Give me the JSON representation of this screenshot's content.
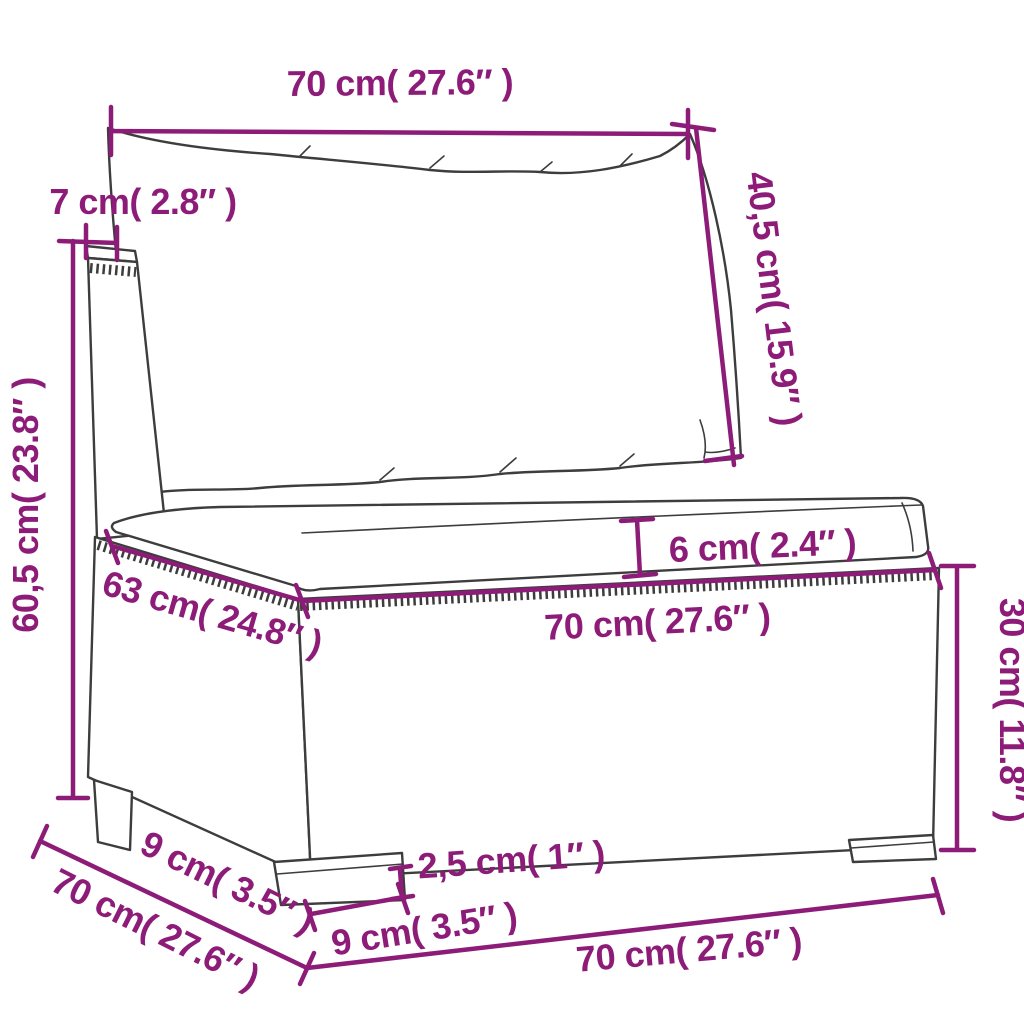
{
  "title": "Sofa section dimension diagram",
  "product": "poly rattan garden sofa middle section with back and seat cushions",
  "colors": {
    "dimension": "#8D1C78",
    "line_art": "#3D3D3D",
    "background": "#FFFFFF"
  },
  "dimensions": {
    "back_cushion_width": "70 cm( 27.6″ )",
    "back_cushion_height": "40,5 cm( 15.9″ )",
    "back_frame_thickness": "7 cm( 2.8″ )",
    "total_height": "60,5 cm( 23.8″ )",
    "seat_cushion_thickness": "6 cm( 2.4″ )",
    "seat_width": "70 cm( 27.6″ )",
    "seat_depth": "63 cm( 24.8″ )",
    "base_height": "30 cm( 11.8″ )",
    "overall_depth": "70 cm( 27.6″ )",
    "leg_side_width": "9 cm( 3.5″ )",
    "leg_height": "2,5 cm( 1″ )",
    "leg_front_width": "9 cm( 3.5″ )",
    "overall_width": "70 cm( 27.6″ )"
  }
}
